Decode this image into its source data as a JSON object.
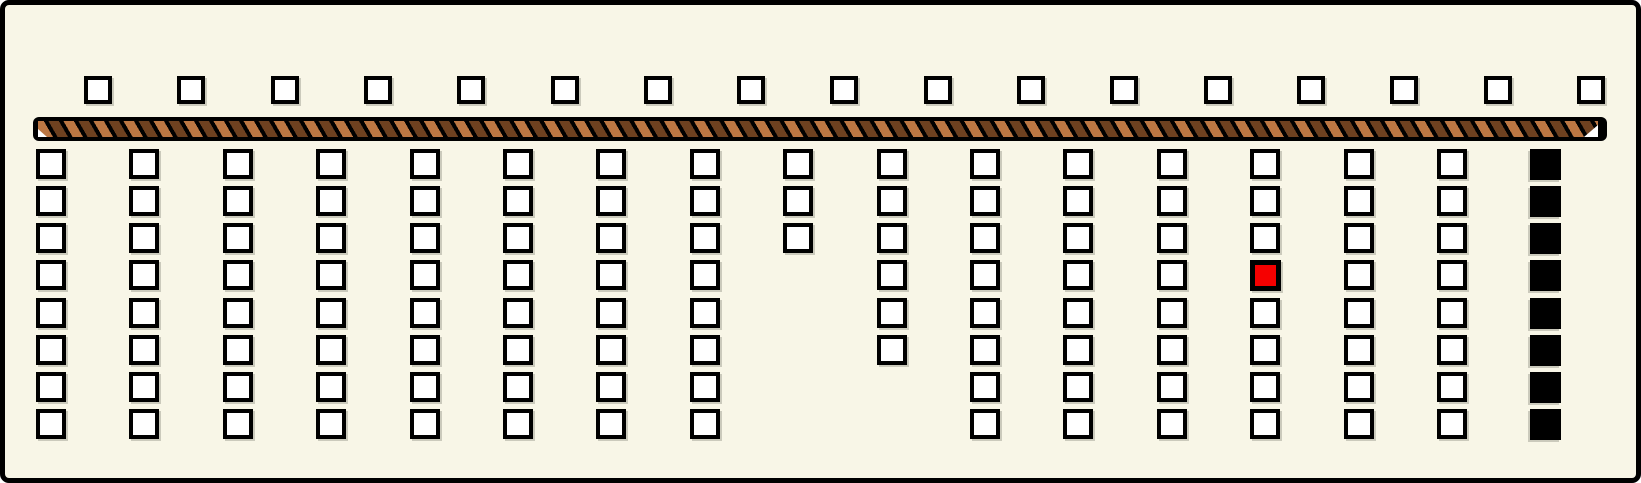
{
  "colors": {
    "background": "#f8f6e7",
    "frame_border": "#000000",
    "cell_fill": "#ffffff",
    "cell_border": "#000000",
    "selected_fill": "#f60000",
    "filled_fill": "#000000",
    "bar_base": "#000000",
    "bar_stripe_light": "#bc7743",
    "bar_stripe_dark": "#6e4120",
    "bar_end_cap": "#ffffff"
  },
  "top_row": {
    "count": 17,
    "cells": [
      "open",
      "open",
      "open",
      "open",
      "open",
      "open",
      "open",
      "open",
      "open",
      "open",
      "open",
      "open",
      "open",
      "open",
      "open",
      "open",
      "open"
    ]
  },
  "divider_bar": {
    "style": "diagonal-stripes",
    "end_marker": "white-triangle-right"
  },
  "board": {
    "column_count": 17,
    "row_count": 8,
    "columns": [
      {
        "cells": [
          "open",
          "open",
          "open",
          "open",
          "open",
          "open",
          "open",
          "open"
        ]
      },
      {
        "cells": [
          "open",
          "open",
          "open",
          "open",
          "open",
          "open",
          "open",
          "open"
        ]
      },
      {
        "cells": [
          "open",
          "open",
          "open",
          "open",
          "open",
          "open",
          "open",
          "open"
        ]
      },
      {
        "cells": [
          "open",
          "open",
          "open",
          "open",
          "open",
          "open",
          "open",
          "open"
        ]
      },
      {
        "cells": [
          "open",
          "open",
          "open",
          "open",
          "open",
          "open",
          "open",
          "open"
        ]
      },
      {
        "cells": [
          "open",
          "open",
          "open",
          "open",
          "open",
          "open",
          "open",
          "open"
        ]
      },
      {
        "cells": [
          "open",
          "open",
          "open",
          "open",
          "open",
          "open",
          "open",
          "open"
        ]
      },
      {
        "cells": [
          "open",
          "open",
          "open",
          "open",
          "open",
          "open",
          "open",
          "open"
        ]
      },
      {
        "cells": [
          "open",
          "open",
          "open"
        ]
      },
      {
        "cells": [
          "open",
          "open",
          "open",
          "open",
          "open",
          "open"
        ]
      },
      {
        "cells": [
          "open",
          "open",
          "open",
          "open",
          "open",
          "open",
          "open",
          "open"
        ]
      },
      {
        "cells": [
          "open",
          "open",
          "open",
          "open",
          "open",
          "open",
          "open",
          "open"
        ]
      },
      {
        "cells": [
          "open",
          "open",
          "open",
          "open",
          "open",
          "open",
          "open",
          "open"
        ]
      },
      {
        "cells": [
          "open",
          "open",
          "open",
          "selected",
          "open",
          "open",
          "open",
          "open"
        ]
      },
      {
        "cells": [
          "open",
          "open",
          "open",
          "open",
          "open",
          "open",
          "open",
          "open"
        ]
      },
      {
        "cells": [
          "open",
          "open",
          "open",
          "open",
          "open",
          "open",
          "open",
          "open"
        ]
      },
      {
        "cells": [
          "filled",
          "filled",
          "filled",
          "filled",
          "filled",
          "filled",
          "filled",
          "filled"
        ]
      }
    ],
    "selected_cell": {
      "column": 14,
      "row": 4
    }
  }
}
